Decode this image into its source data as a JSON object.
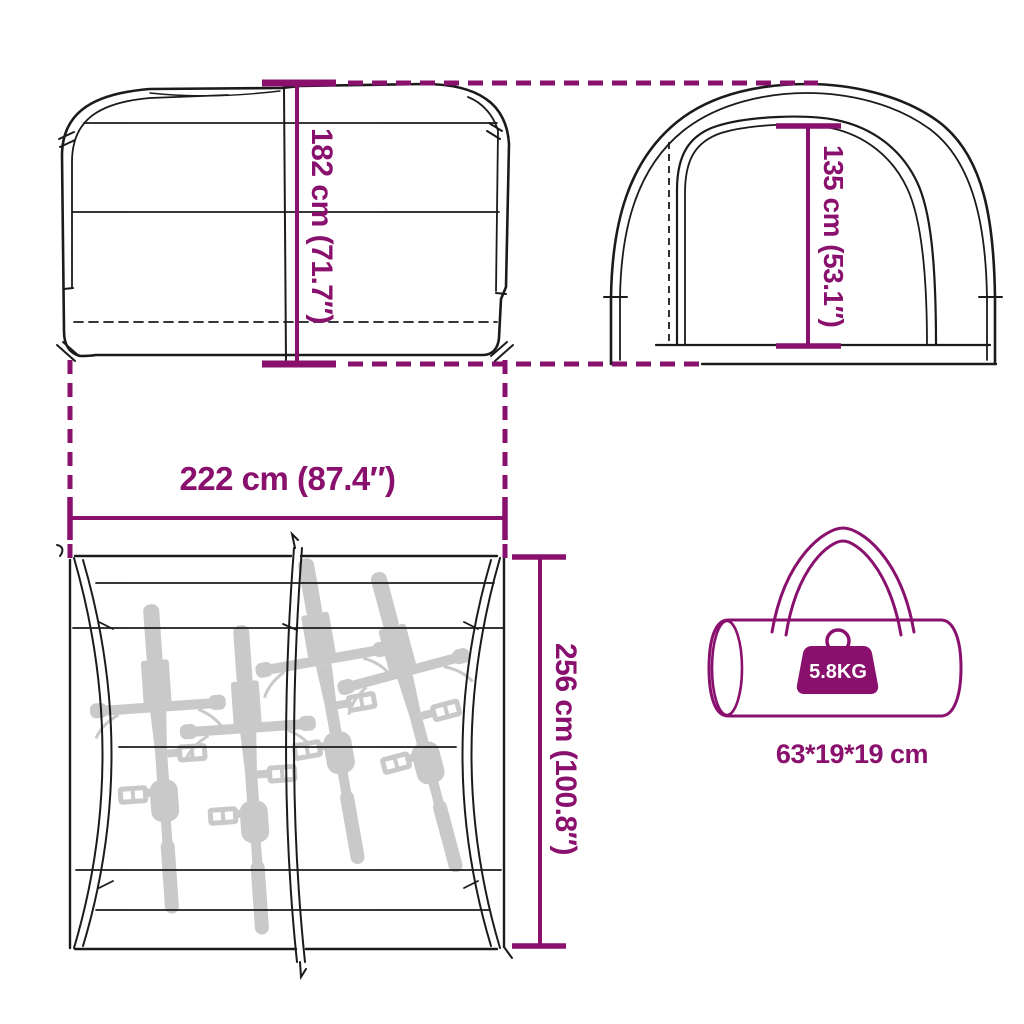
{
  "diagram": {
    "accent_color": "#8A106E",
    "outline_color": "#1B1B1B",
    "bicycle_color": "#C4C4C4",
    "side_view": {
      "height_label": "182 cm (71.7″)"
    },
    "front_view": {
      "height_label": "135 cm (53.1″)"
    },
    "top_view": {
      "width_label": "222 cm (87.4″)",
      "depth_label": "256 cm (100.8″)",
      "bicycle_count": 4
    },
    "carry_bag": {
      "weight_label": "5.8KG",
      "size_label": "63*19*19 cm"
    }
  }
}
